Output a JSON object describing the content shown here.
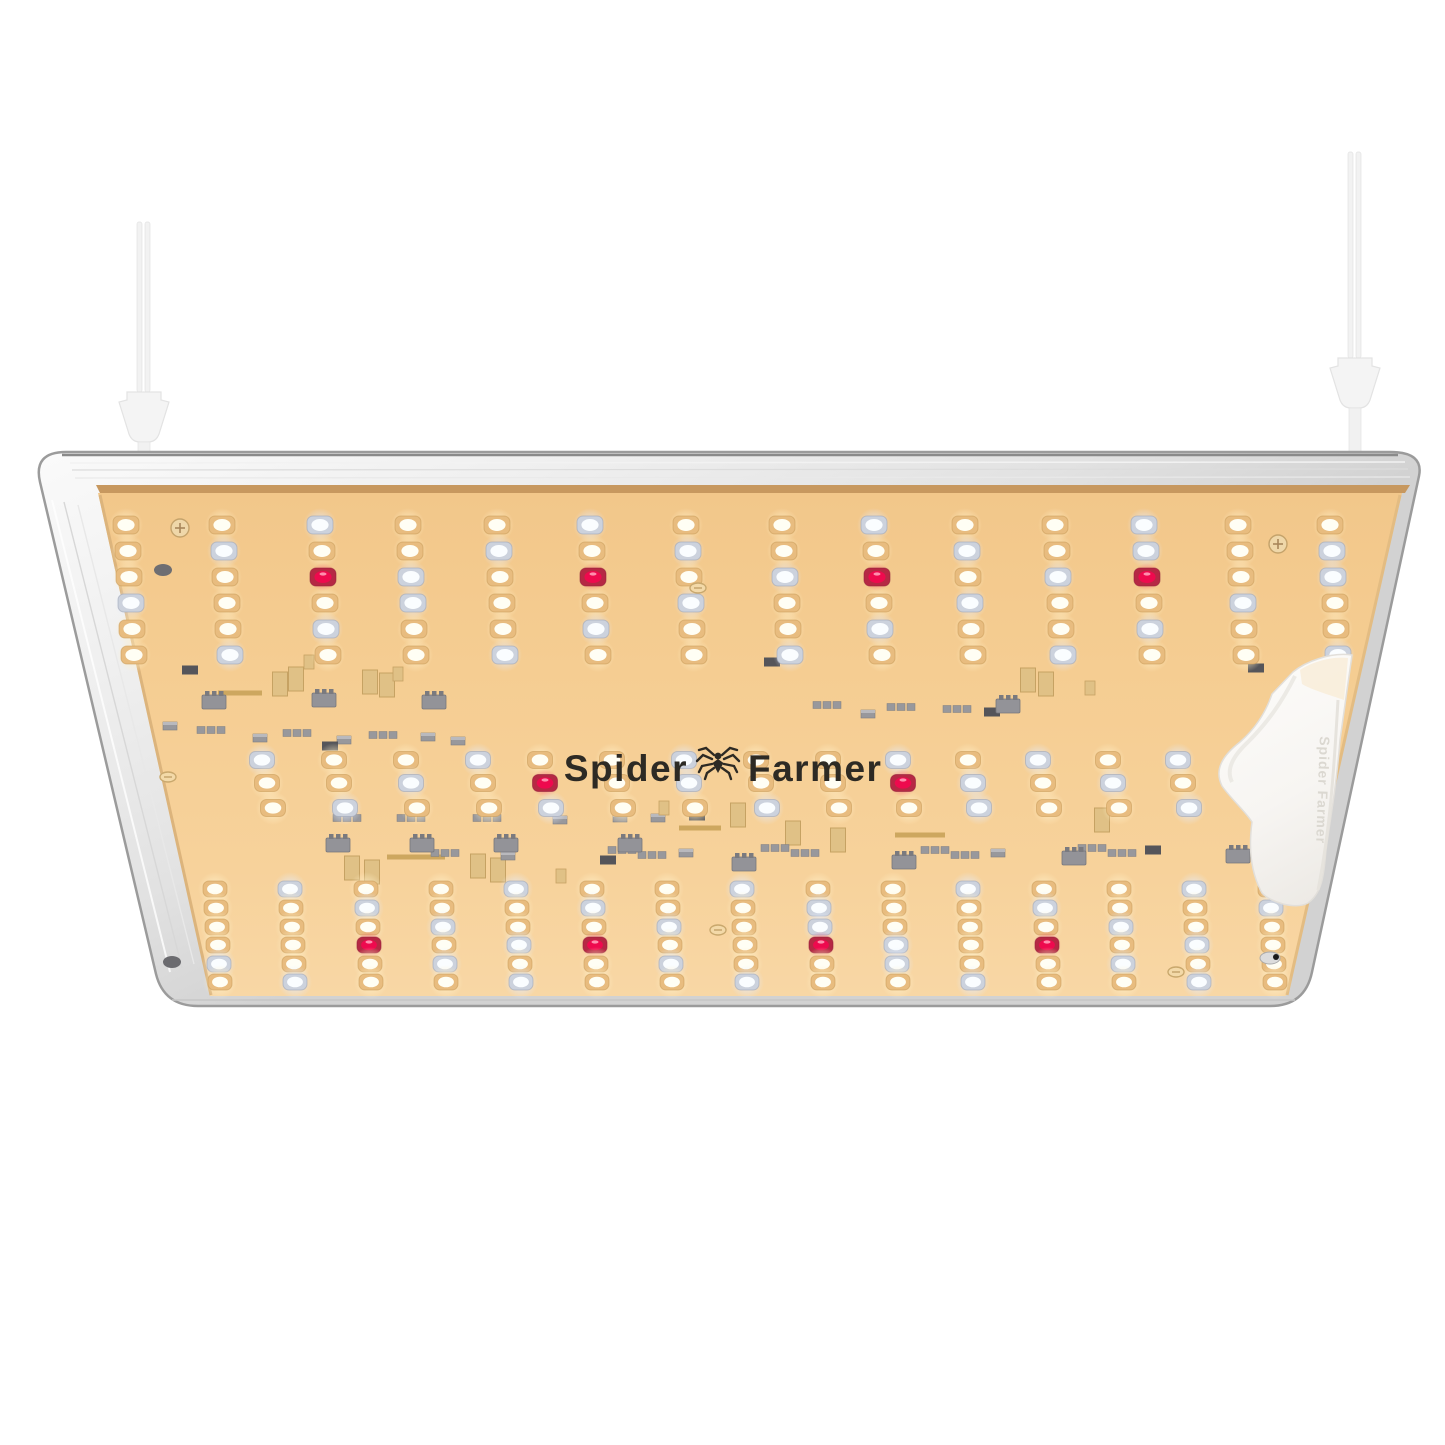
{
  "meta": {
    "subject": "LED quantum board grow light product photo, viewed from below",
    "background_color": "#ffffff"
  },
  "panel": {
    "logo": {
      "left": "Spider",
      "right": "Farmer",
      "icon": "spider-icon",
      "color": "#2d2a24"
    },
    "bracket": {
      "embossed_text": "Spider Farmer",
      "fill": "#faf9f7",
      "edge": "#e6e3de"
    },
    "frame": {
      "silver_light": "#fafafa",
      "silver_mid": "#e3e3e3",
      "silver_dark": "#c9c9c9",
      "outline": "#9b9b9b",
      "top_line": "#8a8a8a",
      "brown_strip": "#c7985f"
    },
    "pcb": {
      "top": "#f2c78a",
      "mid": "#f5cd92",
      "bottom": "#f8d7a5",
      "edge_gold": "#dcb47c"
    }
  },
  "led_palette": {
    "W": {
      "ring": "#e8bc7f",
      "dome": "#fffef4",
      "stroke": "#c89a58",
      "glow": "gW"
    },
    "C": {
      "ring": "#ccd2dd",
      "dome": "#fafdff",
      "stroke": "#9aa2b4",
      "glow": "gC"
    },
    "R": {
      "ring": "#b62844",
      "dome": "#ee0a4e",
      "stroke": "#8e1f38",
      "glow": "gR"
    }
  },
  "led_array": {
    "sections": [
      {
        "name": "top-block",
        "led_w": 26,
        "led_h": 18,
        "cols": [
          126,
          222,
          320,
          408,
          497,
          590,
          686,
          782,
          874,
          965,
          1055,
          1144,
          1238,
          1330
        ],
        "rows": [
          {
            "y": 525,
            "dx": 0
          },
          {
            "y": 551,
            "dx": 2
          },
          {
            "y": 577,
            "dx": 3
          },
          {
            "y": 603,
            "dx": 5
          },
          {
            "y": 629,
            "dx": 6
          },
          {
            "y": 655,
            "dx": 8
          }
        ],
        "pattern": [
          "WWCWWCWWCWWCWW",
          "WCWWCWCWWCWCWC",
          "WWRCWRWCRWCRWC",
          "CWWCWWCWWCWWCW",
          "WWCWWCWWCWWCWW",
          "WCWWCWWCWWCWWC"
        ]
      },
      {
        "name": "middle-block",
        "led_w": 25,
        "led_h": 17,
        "cols": [
          262,
          334,
          406,
          478,
          540,
          612,
          684,
          756,
          828,
          898,
          968,
          1038,
          1108,
          1178
        ],
        "rows": [
          {
            "y": 760,
            "dx": 0
          },
          {
            "y": 783,
            "dx": 5
          },
          {
            "y": 808,
            "dx": 11
          }
        ],
        "pattern": [
          "CWWCWWCWWCWCWC",
          "WWCWRWCWWRCWCW",
          "WCWWCWWCWWCWWC"
        ]
      },
      {
        "name": "bottom-block",
        "led_w": 24,
        "led_h": 16,
        "cols": [
          215,
          290,
          366,
          441,
          516,
          592,
          667,
          742,
          818,
          893,
          968,
          1044,
          1119,
          1194,
          1270
        ],
        "rows": [
          {
            "y": 889,
            "dx": 0
          },
          {
            "y": 908,
            "dx": 1
          },
          {
            "y": 927,
            "dx": 2
          },
          {
            "y": 945,
            "dx": 3
          },
          {
            "y": 964,
            "dx": 4
          },
          {
            "y": 982,
            "dx": 5
          }
        ],
        "pattern": [
          "WCWWCWWCWWCWWCW",
          "WWCWWCWWCWWCWWC",
          "WWWCWWCWCWWWCWW",
          "WWRWCRWWRCWRWCW",
          "CWWCWWCWWCWWCWW",
          "WCWWCWWCWWCWWCW"
        ]
      }
    ]
  },
  "components": {
    "colors": {
      "gray": "#98989c",
      "gray_dark": "#55555a",
      "gray_line": "#7c7c80",
      "gold": "#e0c186",
      "gold_line": "#c6a263",
      "gold_bar": "#cda75f"
    },
    "items": [
      [
        "rd",
        190,
        670
      ],
      [
        "gb",
        240,
        693,
        44
      ],
      [
        "gp",
        280,
        684
      ],
      [
        "gp",
        296,
        679
      ],
      [
        "gs",
        309,
        662
      ],
      [
        "gp",
        370,
        682
      ],
      [
        "gp",
        387,
        685
      ],
      [
        "gs",
        398,
        674
      ],
      [
        "ic",
        214,
        702
      ],
      [
        "ic",
        324,
        700
      ],
      [
        "ic",
        434,
        702
      ],
      [
        "rc",
        212,
        730
      ],
      [
        "rc",
        298,
        733
      ],
      [
        "rc",
        384,
        735
      ],
      [
        "r",
        170,
        726
      ],
      [
        "r",
        260,
        738
      ],
      [
        "r",
        344,
        740
      ],
      [
        "r",
        428,
        737
      ],
      [
        "r",
        458,
        741
      ],
      [
        "rd",
        330,
        746
      ],
      [
        "rd",
        772,
        662
      ],
      [
        "rc",
        828,
        705
      ],
      [
        "rc",
        902,
        707
      ],
      [
        "r",
        868,
        714
      ],
      [
        "rc",
        958,
        709
      ],
      [
        "rd",
        992,
        712
      ],
      [
        "ic",
        1008,
        706
      ],
      [
        "gp",
        1028,
        680
      ],
      [
        "gp",
        1046,
        684
      ],
      [
        "gs",
        1090,
        688
      ],
      [
        "rd",
        1256,
        668
      ],
      [
        "r",
        658,
        818
      ],
      [
        "rd",
        697,
        816
      ],
      [
        "gs",
        664,
        808
      ],
      [
        "rc",
        348,
        818
      ],
      [
        "rc",
        412,
        818
      ],
      [
        "rc",
        488,
        818
      ],
      [
        "r",
        560,
        820
      ],
      [
        "r",
        620,
        818
      ],
      [
        "gb",
        700,
        828,
        42
      ],
      [
        "gp",
        738,
        815
      ],
      [
        "gb",
        416,
        857,
        58
      ],
      [
        "gp",
        352,
        868
      ],
      [
        "gp",
        372,
        872
      ],
      [
        "gp",
        478,
        866
      ],
      [
        "gp",
        498,
        870
      ],
      [
        "rc",
        446,
        853
      ],
      [
        "r",
        508,
        856
      ],
      [
        "gs",
        561,
        876
      ],
      [
        "rd",
        608,
        860
      ],
      [
        "rc",
        623,
        850
      ],
      [
        "rc",
        653,
        855
      ],
      [
        "r",
        686,
        853
      ],
      [
        "gp",
        793,
        833
      ],
      [
        "gp",
        838,
        840
      ],
      [
        "rc",
        776,
        848
      ],
      [
        "rc",
        806,
        853
      ],
      [
        "rc",
        936,
        850
      ],
      [
        "rc",
        966,
        855
      ],
      [
        "r",
        998,
        853
      ],
      [
        "gb",
        920,
        835,
        50
      ],
      [
        "rc",
        1093,
        848
      ],
      [
        "rc",
        1123,
        853
      ],
      [
        "rd",
        1153,
        850
      ],
      [
        "gp",
        1102,
        820
      ],
      [
        "ic",
        338,
        845
      ],
      [
        "ic",
        422,
        845
      ],
      [
        "ic",
        506,
        845
      ],
      [
        "ic",
        630,
        845
      ],
      [
        "ic",
        744,
        864
      ],
      [
        "ic",
        904,
        862
      ],
      [
        "ic",
        1074,
        858
      ],
      [
        "ic",
        1238,
        856
      ]
    ]
  },
  "hardware": {
    "screws_cross": [
      [
        180,
        528
      ],
      [
        1278,
        544
      ]
    ],
    "rivets": [
      [
        698,
        588
      ],
      [
        168,
        777
      ],
      [
        718,
        930
      ],
      [
        1176,
        972
      ]
    ],
    "notch_dark": [
      [
        163,
        570
      ]
    ],
    "notch_bottom_left": [
      172,
      962
    ],
    "notch_bottom_right": [
      1270,
      958
    ]
  },
  "wires": {
    "color": "#f2f2f2",
    "edge": "#e3e3e3",
    "left": {
      "x": 144,
      "top": 222,
      "plug_top": 392
    },
    "right": {
      "x": 1355,
      "top": 152,
      "plug_top": 358
    }
  }
}
